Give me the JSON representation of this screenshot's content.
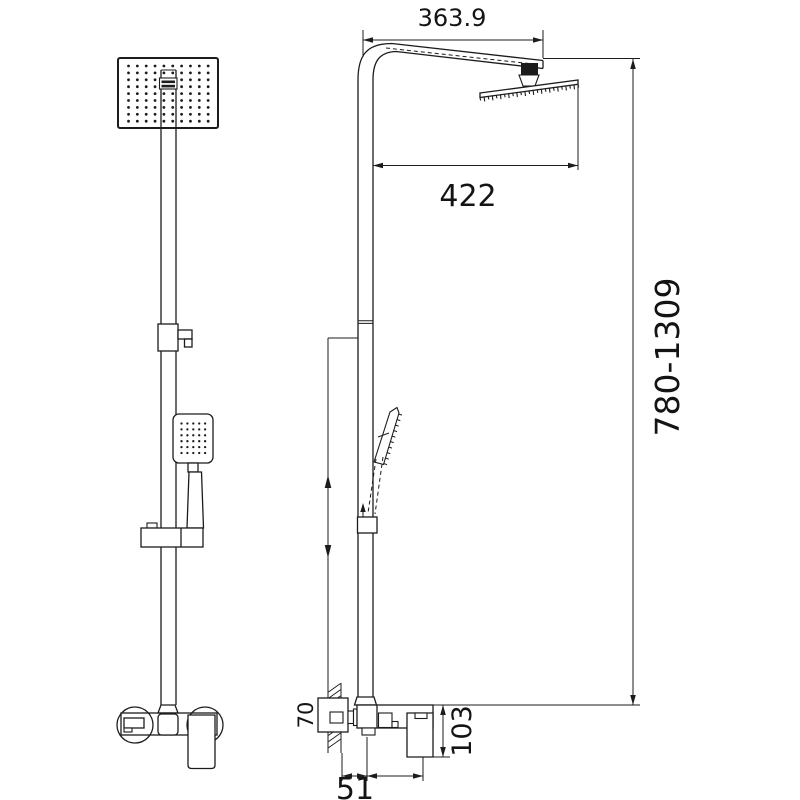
{
  "drawing": {
    "kind": "shower-column-technical-drawing",
    "views": {
      "left": "front-elevation",
      "right": "side-elevation"
    }
  },
  "dimensions": {
    "arm_length": "363.9",
    "head_width": "422",
    "height_range": "780-1309",
    "wall_plate": "70",
    "mixer_height": "103",
    "wall_to_pipe": "51",
    "pipe_to_handle": "110"
  },
  "style": {
    "line_color": "#1c1c1c",
    "background": "#ffffff",
    "text_color": "#141414"
  },
  "nozzles": {
    "overhead_grid": {
      "cols": 10,
      "rows": 9
    },
    "hand_grid": {
      "cols": 5,
      "rows": 6
    }
  }
}
